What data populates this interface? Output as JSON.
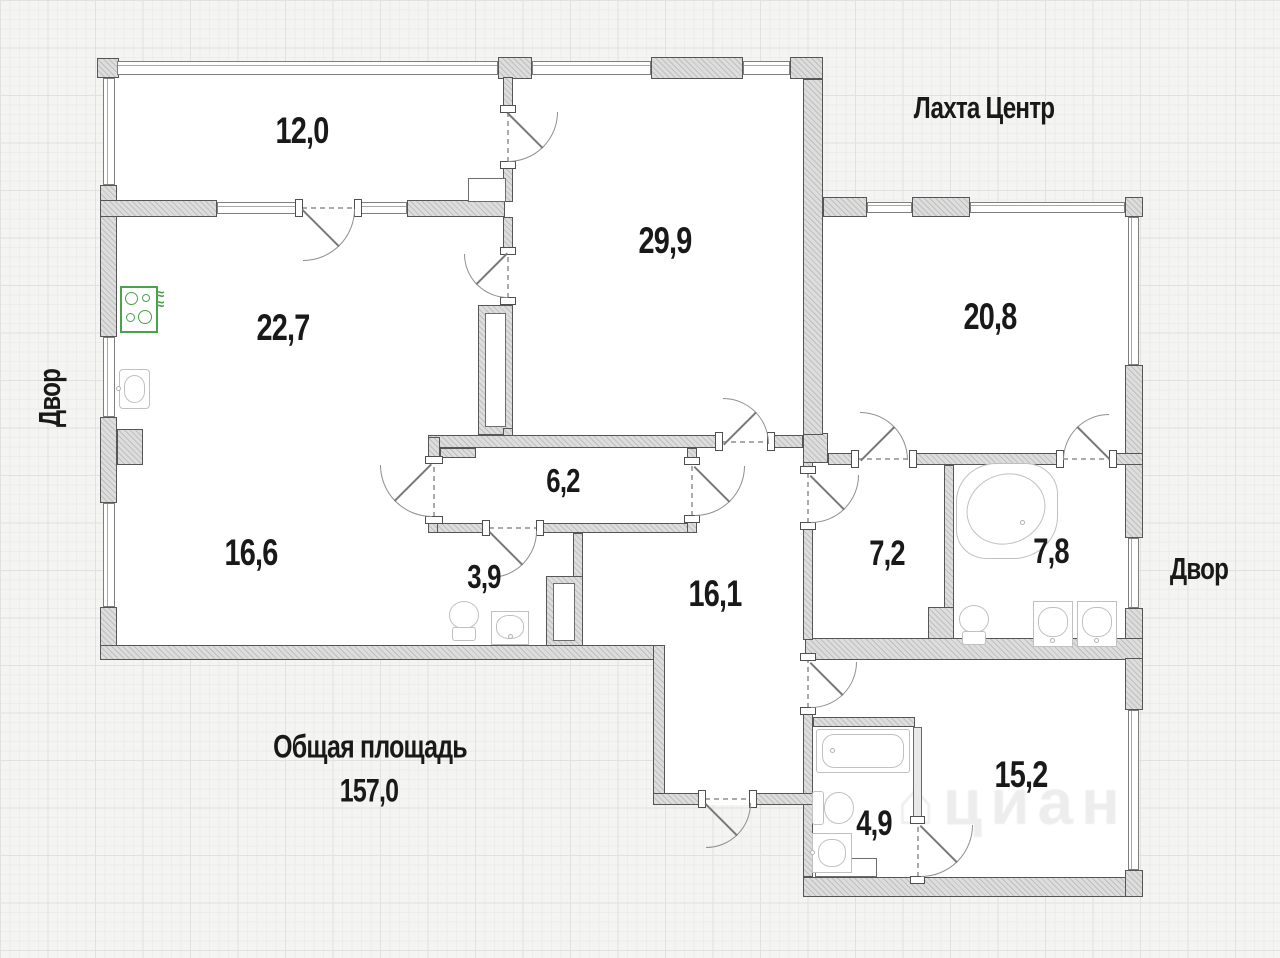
{
  "plan": {
    "landmarks": {
      "top": "Лахта Центр",
      "left": "Двор",
      "right": "Двор"
    },
    "total_area": {
      "label": "Общая площадь",
      "value": "157,0"
    },
    "watermark": "⌂циан",
    "rooms": [
      {
        "area": "12,0"
      },
      {
        "area": "22,7"
      },
      {
        "area": "29,9"
      },
      {
        "area": "20,8"
      },
      {
        "area": "6,2"
      },
      {
        "area": "16,6"
      },
      {
        "area": "3,9"
      },
      {
        "area": "16,1"
      },
      {
        "area": "7,2"
      },
      {
        "area": "7,8"
      },
      {
        "area": "4,9"
      },
      {
        "area": "15,2"
      }
    ],
    "fixtures": [
      "stove",
      "kitchen-sink",
      "toilet",
      "wash-basin",
      "corner-bathtub",
      "bathtub"
    ],
    "colors": {
      "stove_accent": "#4aa34a",
      "wall_fill": "#d6d6d6",
      "text": "#191919"
    }
  }
}
